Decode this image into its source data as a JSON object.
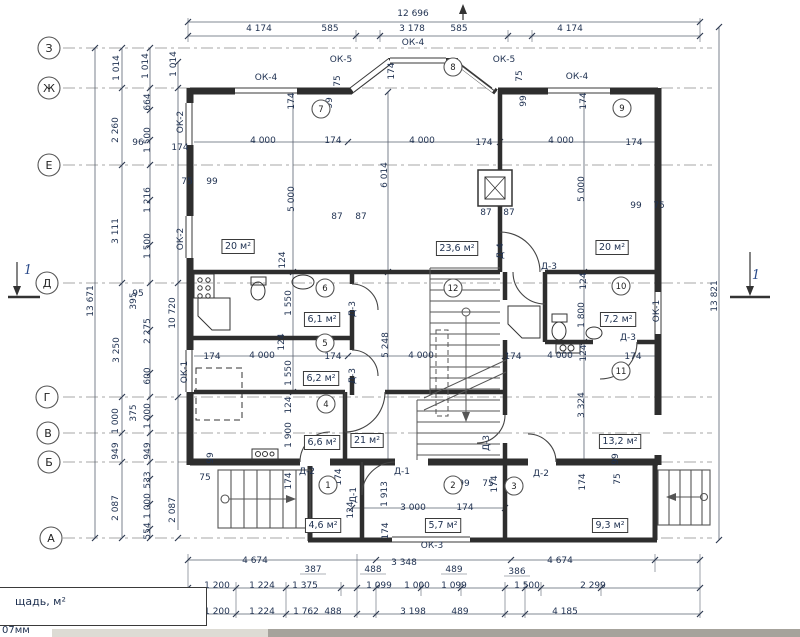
{
  "footer": {
    "table_label": "щадь, м²",
    "note": "07мм"
  },
  "plan": {
    "colors": {
      "line": "#3a3a3a",
      "dim_text": "#1e3050",
      "accent_blue": "#2a4a8a",
      "scroll_track": "#dddbd4",
      "scroll_thumb": "#a6a39c"
    },
    "axes": [
      {
        "t": "З",
        "x": 49,
        "y": 48
      },
      {
        "t": "Ж",
        "x": 49,
        "y": 88
      },
      {
        "t": "Е",
        "x": 49,
        "y": 165
      },
      {
        "t": "Д",
        "x": 47,
        "y": 283
      },
      {
        "t": "Г",
        "x": 47,
        "y": 397
      },
      {
        "t": "В",
        "x": 48,
        "y": 433
      },
      {
        "t": "Б",
        "x": 49,
        "y": 462
      },
      {
        "t": "А",
        "x": 51,
        "y": 538
      }
    ],
    "nodes": [
      {
        "t": "1",
        "x": 328,
        "y": 485
      },
      {
        "t": "2",
        "x": 453,
        "y": 485
      },
      {
        "t": "3",
        "x": 514,
        "y": 486
      },
      {
        "t": "4",
        "x": 326,
        "y": 404
      },
      {
        "t": "5",
        "x": 325,
        "y": 343
      },
      {
        "t": "6",
        "x": 325,
        "y": 288
      },
      {
        "t": "7",
        "x": 321,
        "y": 109
      },
      {
        "t": "8",
        "x": 453,
        "y": 67
      },
      {
        "t": "9",
        "x": 622,
        "y": 108
      },
      {
        "t": "10",
        "x": 621,
        "y": 286
      },
      {
        "t": "11",
        "x": 621,
        "y": 371
      },
      {
        "t": "12",
        "x": 453,
        "y": 288
      }
    ],
    "rooms": [
      {
        "t": "20 м²",
        "x": 238,
        "y": 249
      },
      {
        "t": "23,6 м²",
        "x": 457,
        "y": 251
      },
      {
        "t": "20 м²",
        "x": 612,
        "y": 250
      },
      {
        "t": "6,1 м²",
        "x": 322,
        "y": 322
      },
      {
        "t": "7,2 м²",
        "x": 618,
        "y": 322
      },
      {
        "t": "6,2 м²",
        "x": 321,
        "y": 381
      },
      {
        "t": "6,6 м²",
        "x": 322,
        "y": 445
      },
      {
        "t": "21 м²",
        "x": 367,
        "y": 443
      },
      {
        "t": "13,2 м²",
        "x": 620,
        "y": 444
      },
      {
        "t": "4,6 м²",
        "x": 323,
        "y": 528
      },
      {
        "t": "5,7 м²",
        "x": 443,
        "y": 528
      },
      {
        "t": "9,3 м²",
        "x": 610,
        "y": 528
      }
    ],
    "texts": [
      {
        "t": "12 696",
        "x": 413,
        "y": 16
      },
      {
        "t": "4 174",
        "x": 259,
        "y": 31
      },
      {
        "t": "585",
        "x": 330,
        "y": 31
      },
      {
        "t": "3 178",
        "x": 412,
        "y": 31
      },
      {
        "t": "585",
        "x": 459,
        "y": 31
      },
      {
        "t": "4 174",
        "x": 570,
        "y": 31
      },
      {
        "t": "ОК-4",
        "x": 413,
        "y": 45
      },
      {
        "t": "ОК-5",
        "x": 341,
        "y": 62
      },
      {
        "t": "ОК-5",
        "x": 504,
        "y": 62
      },
      {
        "t": "ОК-4",
        "x": 266,
        "y": 80
      },
      {
        "t": "ОК-4",
        "x": 577,
        "y": 79
      },
      {
        "t": "174",
        "x": 394,
        "y": 71,
        "r": 1
      },
      {
        "t": "75",
        "x": 340,
        "y": 81,
        "r": 1
      },
      {
        "t": "99",
        "x": 332,
        "y": 103,
        "r": 1
      },
      {
        "t": "75",
        "x": 522,
        "y": 76,
        "r": 1
      },
      {
        "t": "99",
        "x": 526,
        "y": 101,
        "r": 1
      },
      {
        "t": "174",
        "x": 294,
        "y": 101,
        "r": 1
      },
      {
        "t": "174",
        "x": 586,
        "y": 101,
        "r": 1
      },
      {
        "t": "ОК-2",
        "x": 183,
        "y": 122,
        "r": 1
      },
      {
        "t": "ОК-2",
        "x": 183,
        "y": 239,
        "r": 1
      },
      {
        "t": "ОК-1",
        "x": 187,
        "y": 372,
        "r": 1
      },
      {
        "t": "ОК-1",
        "x": 659,
        "y": 311,
        "r": 1
      },
      {
        "t": "4 000",
        "x": 263,
        "y": 143
      },
      {
        "t": "174",
        "x": 333,
        "y": 143
      },
      {
        "t": "4 000",
        "x": 422,
        "y": 143
      },
      {
        "t": "174",
        "x": 484,
        "y": 145
      },
      {
        "t": "4 000",
        "x": 561,
        "y": 143
      },
      {
        "t": "174",
        "x": 634,
        "y": 145
      },
      {
        "t": "6 014",
        "x": 387,
        "y": 175,
        "r": 1
      },
      {
        "t": "5 000",
        "x": 294,
        "y": 199,
        "r": 1
      },
      {
        "t": "5 000",
        "x": 584,
        "y": 189,
        "r": 1
      },
      {
        "t": "75",
        "x": 187,
        "y": 184
      },
      {
        "t": "99",
        "x": 212,
        "y": 184
      },
      {
        "t": "87",
        "x": 337,
        "y": 219
      },
      {
        "t": "87",
        "x": 361,
        "y": 219
      },
      {
        "t": "87",
        "x": 486,
        "y": 215
      },
      {
        "t": "87",
        "x": 509,
        "y": 215
      },
      {
        "t": "99",
        "x": 636,
        "y": 208
      },
      {
        "t": "75",
        "x": 659,
        "y": 208
      },
      {
        "t": "1 014",
        "x": 119,
        "y": 68,
        "r": 1
      },
      {
        "t": "1 014",
        "x": 148,
        "y": 66,
        "r": 1
      },
      {
        "t": "1 014",
        "x": 176,
        "y": 64,
        "r": 1
      },
      {
        "t": "664",
        "x": 150,
        "y": 102,
        "r": 1
      },
      {
        "t": "2 260",
        "x": 118,
        "y": 130,
        "r": 1
      },
      {
        "t": "1 500",
        "x": 150,
        "y": 140,
        "r": 1
      },
      {
        "t": "96",
        "x": 138,
        "y": 145
      },
      {
        "t": "174",
        "x": 180,
        "y": 150
      },
      {
        "t": "1 216",
        "x": 150,
        "y": 200,
        "r": 1
      },
      {
        "t": "3 111",
        "x": 118,
        "y": 231,
        "r": 1
      },
      {
        "t": "1 500",
        "x": 150,
        "y": 246,
        "r": 1
      },
      {
        "t": "95",
        "x": 138,
        "y": 296
      },
      {
        "t": "13 671",
        "x": 93,
        "y": 301,
        "r": 1
      },
      {
        "t": "395",
        "x": 136,
        "y": 301,
        "r": 1
      },
      {
        "t": "10 720",
        "x": 175,
        "y": 313,
        "r": 1
      },
      {
        "t": "2 275",
        "x": 150,
        "y": 331,
        "r": 1
      },
      {
        "t": "3 250",
        "x": 119,
        "y": 350,
        "r": 1
      },
      {
        "t": "600",
        "x": 150,
        "y": 376,
        "r": 1
      },
      {
        "t": "375",
        "x": 136,
        "y": 413,
        "r": 1
      },
      {
        "t": "1 000",
        "x": 118,
        "y": 421,
        "r": 1
      },
      {
        "t": "1 000",
        "x": 150,
        "y": 416,
        "r": 1
      },
      {
        "t": "949",
        "x": 118,
        "y": 451,
        "r": 1
      },
      {
        "t": "949",
        "x": 150,
        "y": 451,
        "r": 1
      },
      {
        "t": "533",
        "x": 150,
        "y": 480,
        "r": 1
      },
      {
        "t": "2 087",
        "x": 118,
        "y": 508,
        "r": 1
      },
      {
        "t": "1 000",
        "x": 150,
        "y": 506,
        "r": 1
      },
      {
        "t": "554",
        "x": 150,
        "y": 531,
        "r": 1
      },
      {
        "t": "2 087",
        "x": 175,
        "y": 510,
        "r": 1
      },
      {
        "t": "13 821",
        "x": 717,
        "y": 296,
        "r": 1
      },
      {
        "t": "1",
        "x": 28,
        "y": 274,
        "s": 1
      },
      {
        "t": "1",
        "x": 756,
        "y": 279,
        "s": 1
      },
      {
        "t": "124",
        "x": 285,
        "y": 260,
        "r": 1
      },
      {
        "t": "Д-4",
        "x": 503,
        "y": 251,
        "r": 1
      },
      {
        "t": "Д-3",
        "x": 549,
        "y": 269
      },
      {
        "t": "124",
        "x": 586,
        "y": 281,
        "r": 1
      },
      {
        "t": "1 550",
        "x": 291,
        "y": 303,
        "r": 1
      },
      {
        "t": "Д-3",
        "x": 355,
        "y": 309,
        "r": 1
      },
      {
        "t": "1 800",
        "x": 584,
        "y": 315,
        "r": 1
      },
      {
        "t": "Д-3",
        "x": 628,
        "y": 340
      },
      {
        "t": "124",
        "x": 586,
        "y": 353,
        "r": 1
      },
      {
        "t": "5 248",
        "x": 388,
        "y": 345,
        "r": 1
      },
      {
        "t": "124",
        "x": 284,
        "y": 342,
        "r": 1
      },
      {
        "t": "174",
        "x": 212,
        "y": 359
      },
      {
        "t": "4 000",
        "x": 262,
        "y": 358
      },
      {
        "t": "174",
        "x": 333,
        "y": 359
      },
      {
        "t": "4 000",
        "x": 421,
        "y": 358
      },
      {
        "t": "174",
        "x": 513,
        "y": 359
      },
      {
        "t": "4 000",
        "x": 560,
        "y": 358
      },
      {
        "t": "174",
        "x": 633,
        "y": 359
      },
      {
        "t": "1 550",
        "x": 291,
        "y": 373,
        "r": 1
      },
      {
        "t": "Д-3",
        "x": 355,
        "y": 376,
        "r": 1
      },
      {
        "t": "124",
        "x": 291,
        "y": 405,
        "r": 1
      },
      {
        "t": "1 900",
        "x": 291,
        "y": 435,
        "r": 1
      },
      {
        "t": "3 324",
        "x": 584,
        "y": 405,
        "r": 1
      },
      {
        "t": "99",
        "x": 618,
        "y": 459,
        "r": 1
      },
      {
        "t": "75",
        "x": 620,
        "y": 479,
        "r": 1
      },
      {
        "t": "99",
        "x": 213,
        "y": 458,
        "r": 1
      },
      {
        "t": "75",
        "x": 205,
        "y": 480
      },
      {
        "t": "174",
        "x": 341,
        "y": 477,
        "r": 1
      },
      {
        "t": "Д-2",
        "x": 307,
        "y": 474
      },
      {
        "t": "Д-1",
        "x": 402,
        "y": 474
      },
      {
        "t": "1 913",
        "x": 387,
        "y": 494,
        "r": 1
      },
      {
        "t": "Д-1",
        "x": 356,
        "y": 495,
        "r": 1
      },
      {
        "t": "174",
        "x": 291,
        "y": 481,
        "r": 1
      },
      {
        "t": "99",
        "x": 464,
        "y": 486
      },
      {
        "t": "75",
        "x": 488,
        "y": 486
      },
      {
        "t": "Д-3",
        "x": 489,
        "y": 443,
        "r": 1
      },
      {
        "t": "Д-2",
        "x": 541,
        "y": 476
      },
      {
        "t": "174",
        "x": 497,
        "y": 484,
        "r": 1
      },
      {
        "t": "174",
        "x": 585,
        "y": 482,
        "r": 1
      },
      {
        "t": "124",
        "x": 353,
        "y": 510,
        "r": 1
      },
      {
        "t": "3 000",
        "x": 413,
        "y": 510
      },
      {
        "t": "174",
        "x": 465,
        "y": 510
      },
      {
        "t": "174",
        "x": 388,
        "y": 531,
        "r": 1
      },
      {
        "t": "ОК-3",
        "x": 432,
        "y": 548
      },
      {
        "t": "4 674",
        "x": 255,
        "y": 563
      },
      {
        "t": "3 348",
        "x": 404,
        "y": 565
      },
      {
        "t": "4 674",
        "x": 560,
        "y": 563
      },
      {
        "t": "387",
        "x": 313,
        "y": 572
      },
      {
        "t": "488",
        "x": 373,
        "y": 572
      },
      {
        "t": "489",
        "x": 454,
        "y": 572
      },
      {
        "t": "386",
        "x": 517,
        "y": 574
      },
      {
        "t": "1 200",
        "x": 217,
        "y": 588
      },
      {
        "t": "1 224",
        "x": 262,
        "y": 588
      },
      {
        "t": "1 375",
        "x": 305,
        "y": 588
      },
      {
        "t": "1 099",
        "x": 379,
        "y": 588
      },
      {
        "t": "1 000",
        "x": 417,
        "y": 588
      },
      {
        "t": "1 099",
        "x": 454,
        "y": 588
      },
      {
        "t": "1 500",
        "x": 527,
        "y": 588
      },
      {
        "t": "2 299",
        "x": 593,
        "y": 588
      },
      {
        "t": "1 200",
        "x": 217,
        "y": 614
      },
      {
        "t": "1 224",
        "x": 262,
        "y": 614
      },
      {
        "t": "1 762",
        "x": 306,
        "y": 614
      },
      {
        "t": "488",
        "x": 333,
        "y": 614
      },
      {
        "t": "3 198",
        "x": 413,
        "y": 614
      },
      {
        "t": "489",
        "x": 460,
        "y": 614
      },
      {
        "t": "4 185",
        "x": 565,
        "y": 614
      }
    ]
  }
}
